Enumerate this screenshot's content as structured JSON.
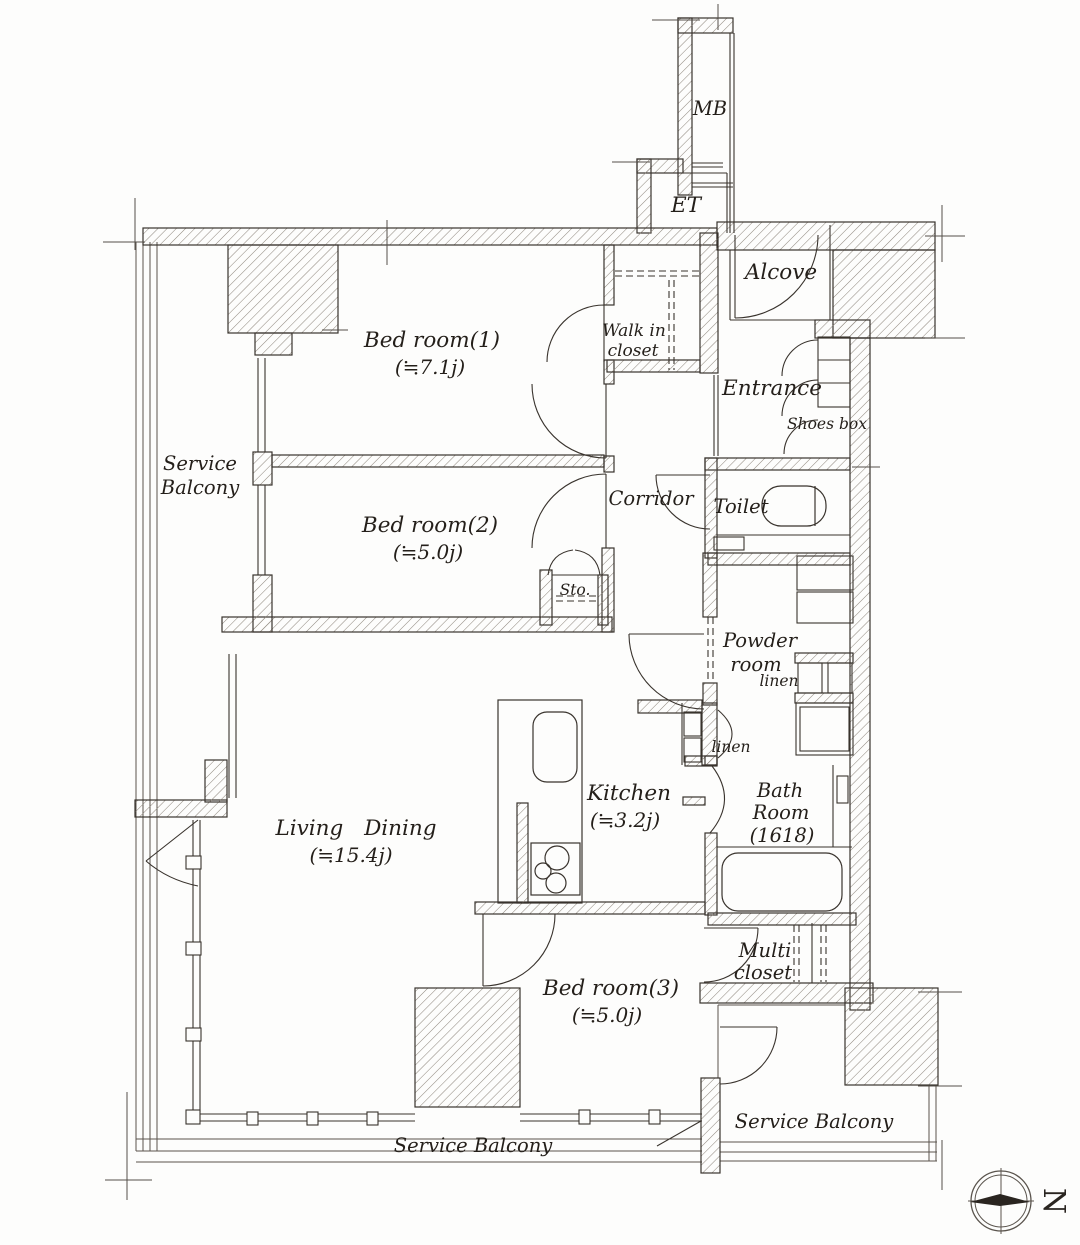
{
  "colors": {
    "ink": "#39332d",
    "paper": "#fdfdfc",
    "hatch_line": "#8f877e"
  },
  "rooms": {
    "mb": {
      "name": "MB"
    },
    "et": {
      "name": "ET"
    },
    "alcove": {
      "name": "Alcove"
    },
    "entrance": {
      "name": "Entrance"
    },
    "shoes_box": {
      "name": "Shoes box"
    },
    "bedroom1": {
      "name": "Bed room(1)",
      "area": "(≒7.1j)"
    },
    "walk_in_closet": {
      "line1": "Walk in",
      "line2": "closet"
    },
    "service_balcony_left": {
      "line1": "Service",
      "line2": "Balcony"
    },
    "bedroom2": {
      "name": "Bed room(2)",
      "area": "(≒5.0j)"
    },
    "corridor": {
      "name": "Corridor"
    },
    "toilet": {
      "name": "Toilet"
    },
    "storage": {
      "name": "Sto."
    },
    "powder_room": {
      "line1": "Powder",
      "line2": "room"
    },
    "linen_upper": {
      "name": "linen"
    },
    "linen_lower": {
      "name": "linen"
    },
    "kitchen": {
      "name": "Kitchen",
      "area": "(≒3.2j)"
    },
    "living_dining": {
      "name": "Living Dining",
      "area": "(≒15.4j)"
    },
    "bath_room": {
      "line1": "Bath",
      "line2": "Room",
      "line3": "(1618)"
    },
    "multi_closet": {
      "line1": "Multi",
      "line2": "closet"
    },
    "bedroom3": {
      "name": "Bed room(3)",
      "area": "(≒5.0j)"
    },
    "service_balcony_bottom": {
      "name": "Service Balcony"
    },
    "service_balcony_right": {
      "name": "Service Balcony"
    }
  },
  "compass": {
    "letter": "N"
  }
}
